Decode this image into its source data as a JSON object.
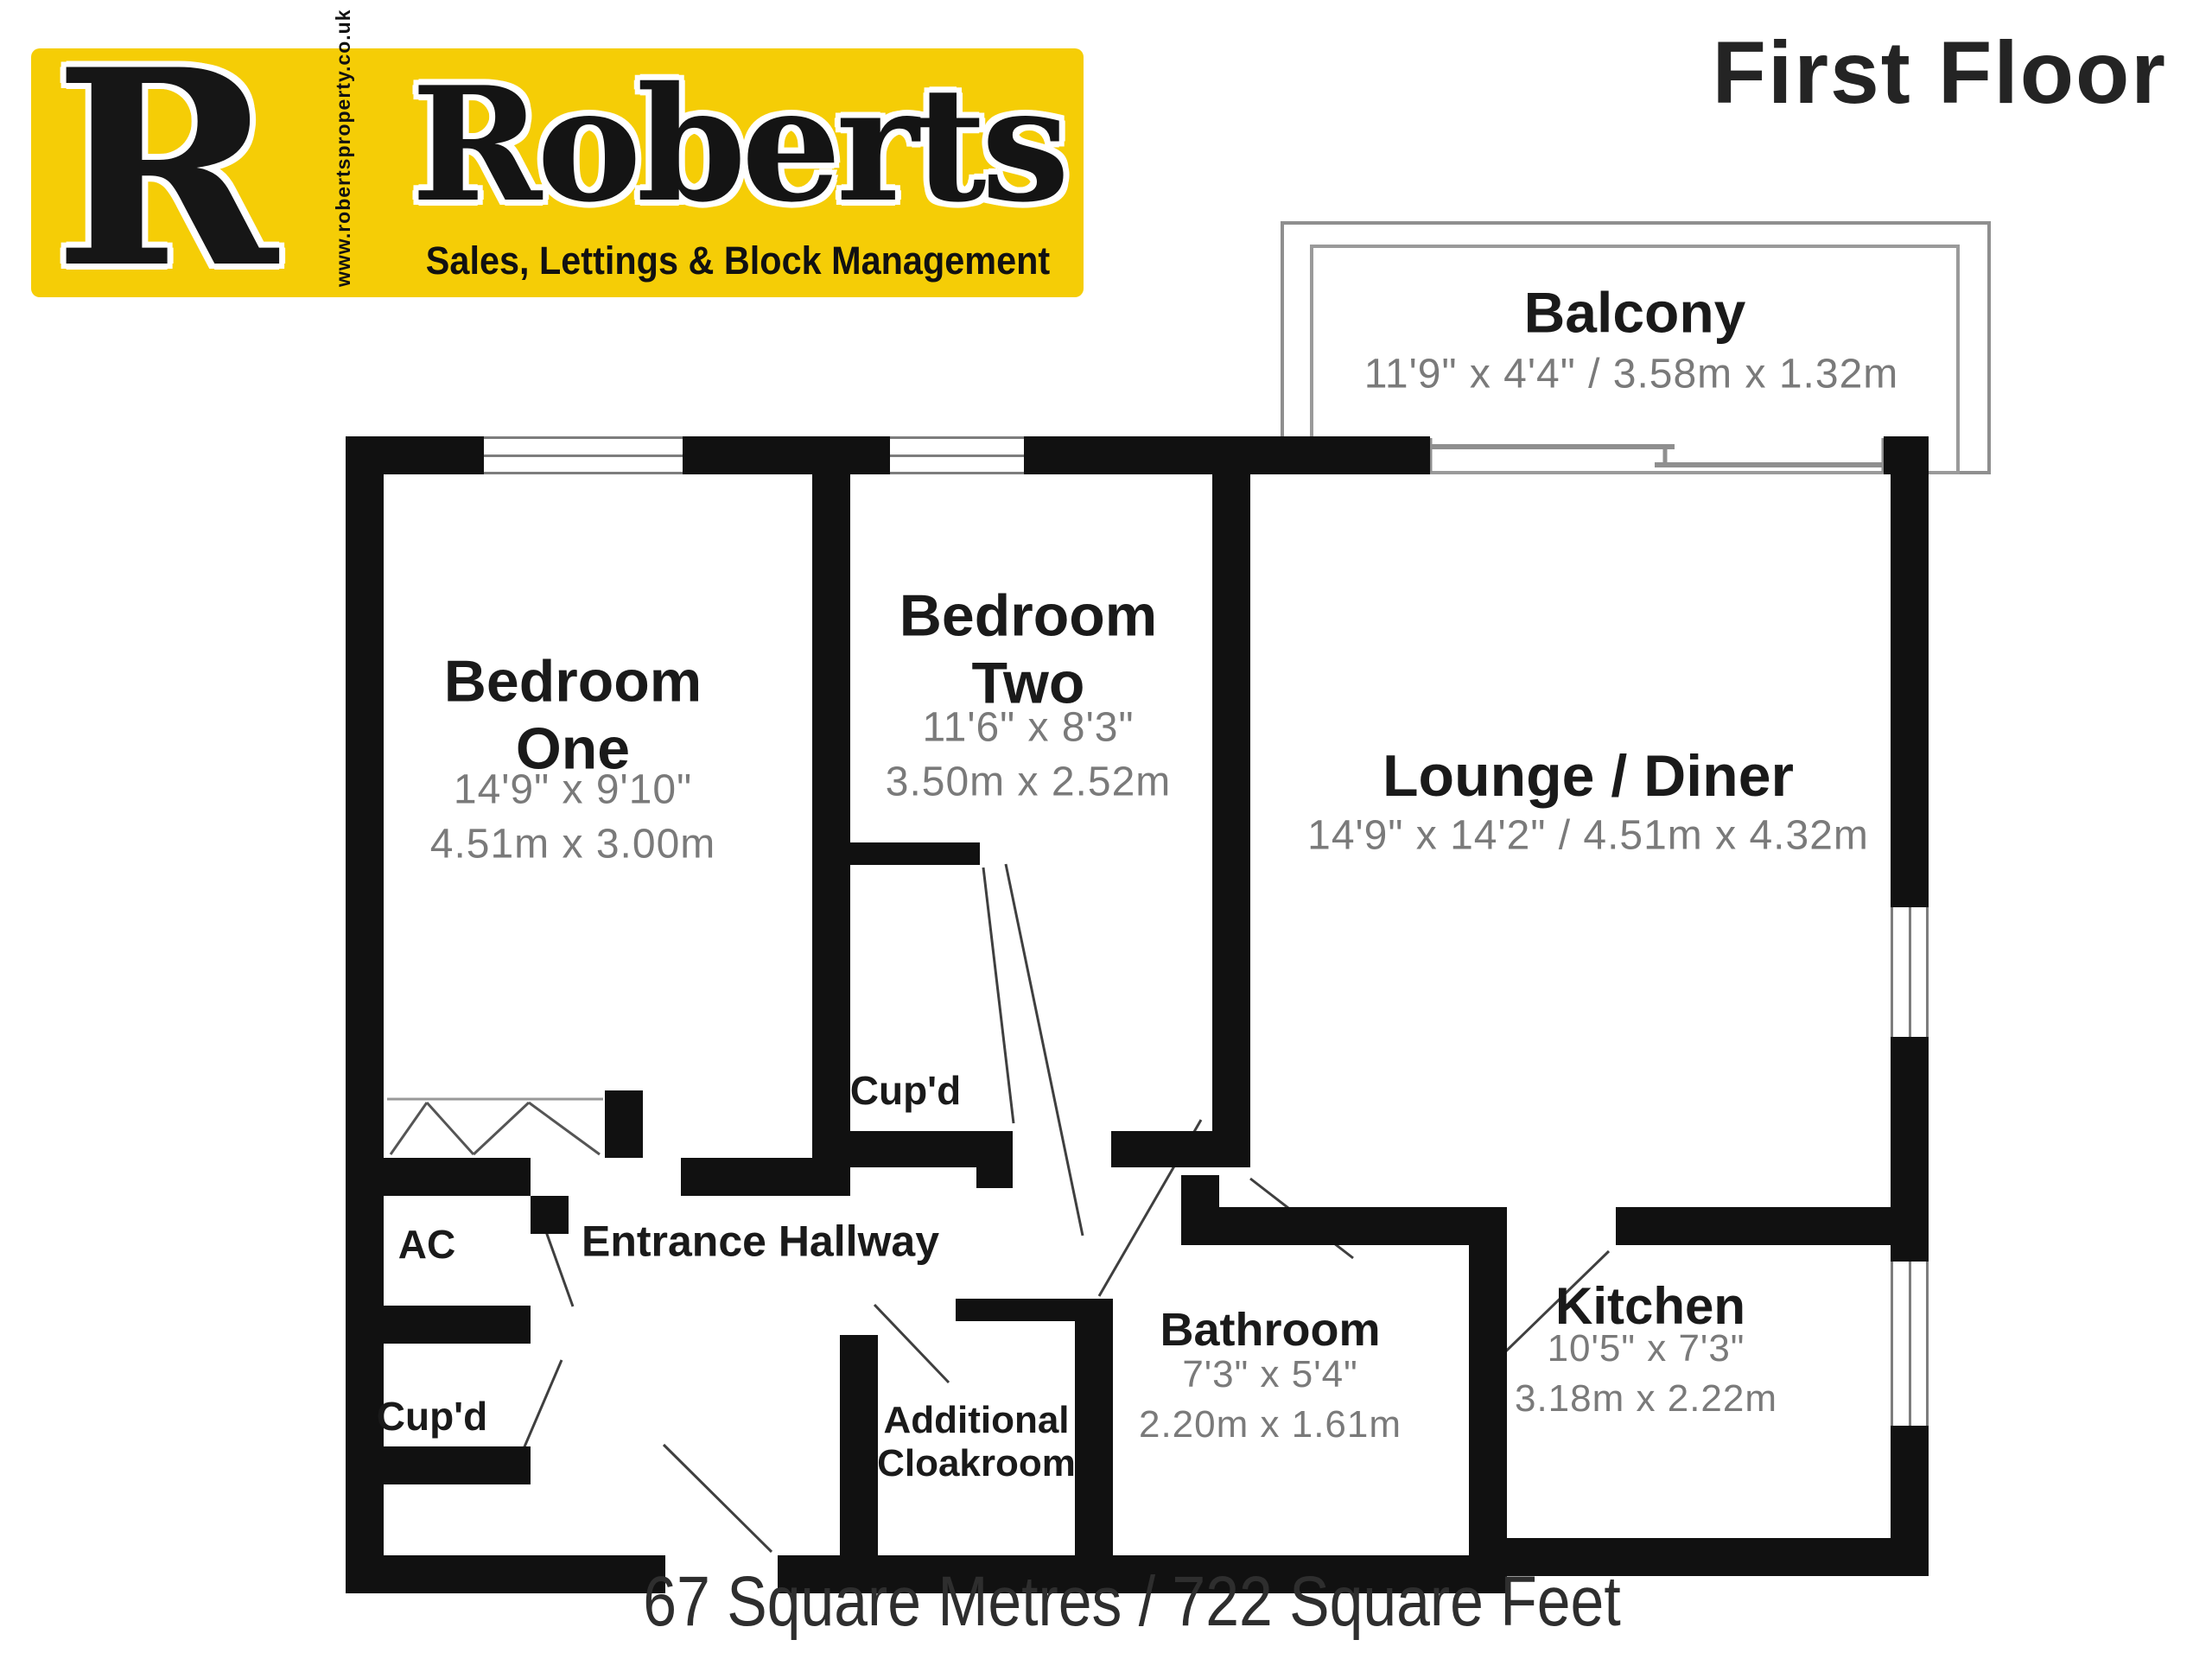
{
  "colors": {
    "logo_background": "#F5CD06",
    "wall": "#111111",
    "room_name_text": "#1a1a1a",
    "dimensions_text": "#7a7a7a"
  },
  "header": {
    "logo": {
      "letter": "R",
      "website": "www.robertsproperty.co.uk",
      "brand": "Roberts",
      "tagline": "Sales, Lettings & Block Management"
    },
    "floor_title": "First Floor"
  },
  "rooms": {
    "balcony": {
      "name": "Balcony",
      "dims": "11'9\" x 4'4\" / 3.58m x 1.32m"
    },
    "bedroom_one": {
      "name": "Bedroom\nOne",
      "dims": "14'9\" x 9'10\"\n4.51m x 3.00m"
    },
    "bedroom_two": {
      "name": "Bedroom\nTwo",
      "dims": "11'6\" x 8'3\"\n3.50m x 2.52m"
    },
    "lounge_diner": {
      "name": "Lounge / Diner",
      "dims": "14'9\" x 14'2\" / 4.51m x 4.32m"
    },
    "kitchen": {
      "name": "Kitchen",
      "dims": "10'5\" x 7'3\"\n3.18m x 2.22m"
    },
    "bathroom": {
      "name": "Bathroom",
      "dims": "7'3\" x 5'4\"\n2.20m x 1.61m"
    },
    "additional_cloakroom": {
      "name": "Additional\nCloakroom"
    },
    "entrance_hallway": {
      "name": "Entrance Hallway"
    },
    "ac": {
      "name": "AC"
    },
    "cupboard_hall": {
      "name": "Cup'd"
    },
    "cupboard_bedroom_two": {
      "name": "Cup'd"
    }
  },
  "footer": {
    "area_text": "67 Square Metres / 722 Square Feet"
  }
}
